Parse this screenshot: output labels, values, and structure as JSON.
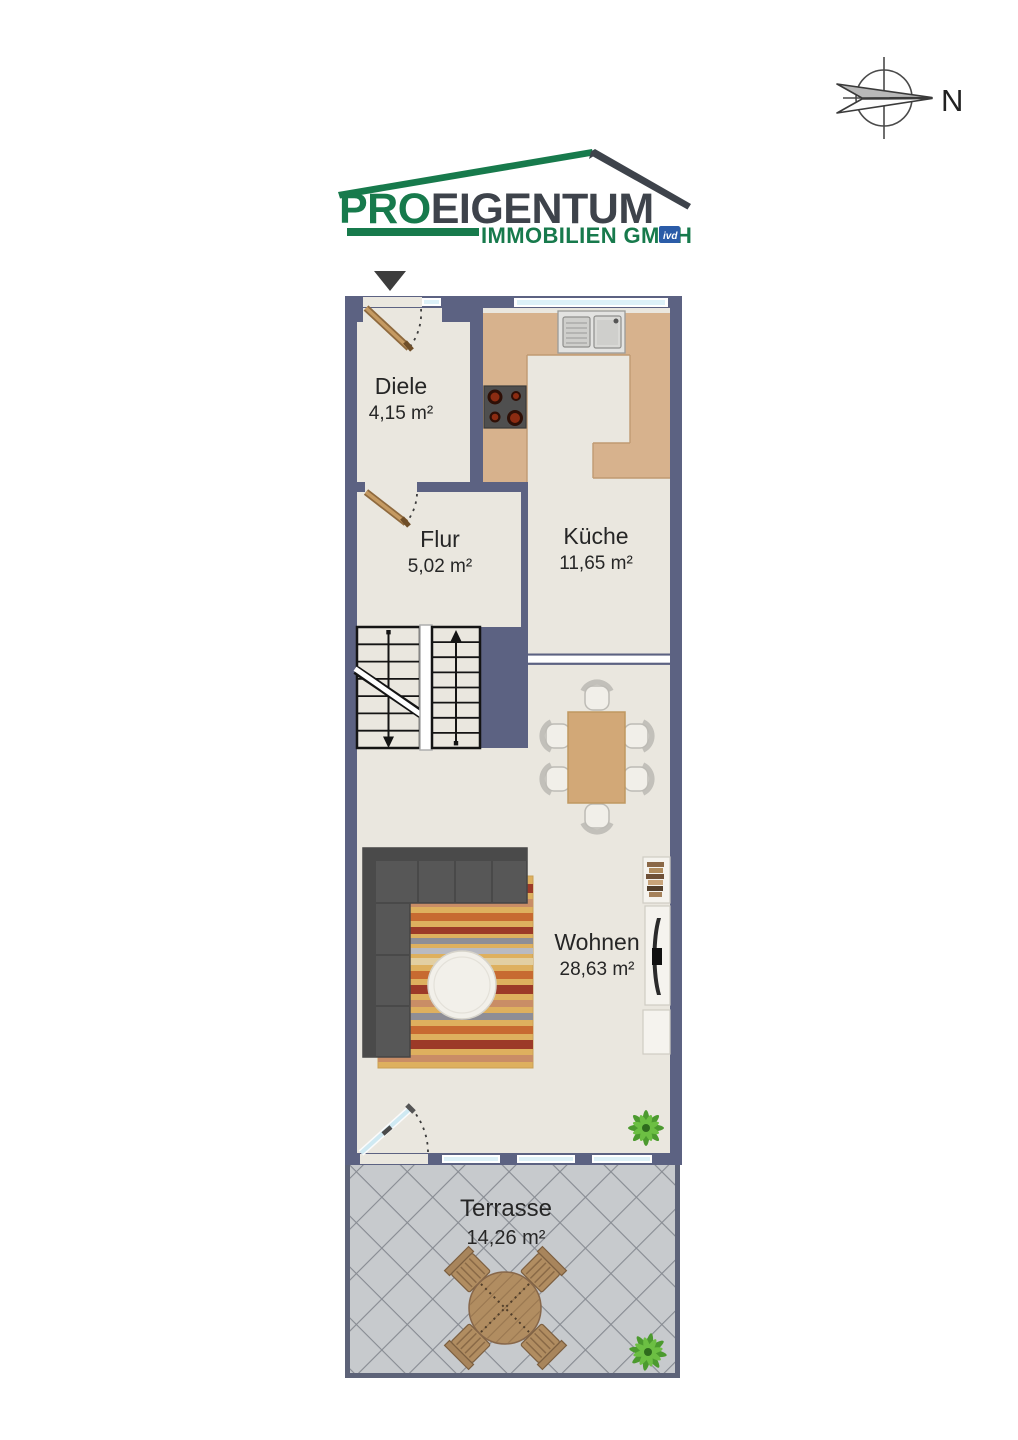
{
  "compass": {
    "north_label": "N"
  },
  "logo": {
    "brand_pro": "PRO",
    "brand_eigentum": "EIGENTUM",
    "subline": "IMMOBILIEN GMBH",
    "badge": "ivd",
    "color_green": "#177a4c",
    "color_dark": "#3e434b",
    "badge_blue": "#2b5ca8"
  },
  "floorplan": {
    "colors": {
      "wall": "#5c6282",
      "floor": "#eae7df",
      "kitchen_counter": "#d7b28d",
      "window_glass": "#ddf1f8",
      "terrace_tile": "#c7cacd",
      "sofa": "#575757",
      "rug_base": "#deb05e",
      "dining_table_wood": "#d2a877",
      "outdoor_wood": "#b18d61"
    },
    "rooms": [
      {
        "name": "Diele",
        "area": "4,15 m²"
      },
      {
        "name": "Flur",
        "area": "5,02 m²"
      },
      {
        "name": "Küche",
        "area": "11,65 m²"
      },
      {
        "name": "Wohnen",
        "area": "28,63 m²"
      },
      {
        "name": "Terrasse",
        "area": "14,26 m²"
      }
    ]
  }
}
